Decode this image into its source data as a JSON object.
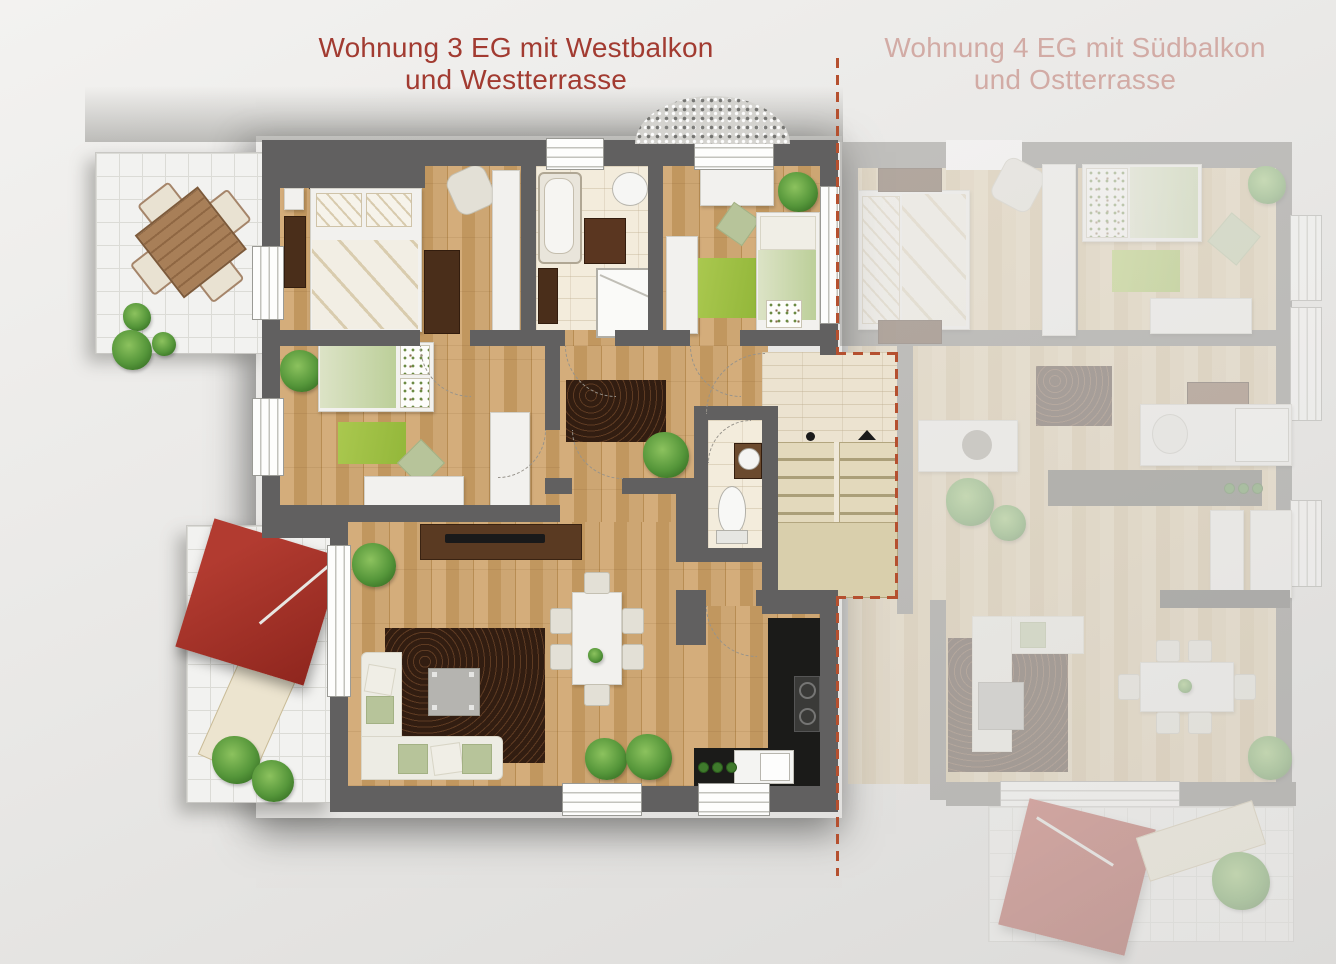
{
  "titles": {
    "apartment3": {
      "line1": "Wohnung 3 EG mit Westbalkon",
      "line2": "und Westterrasse"
    },
    "apartment4": {
      "line1": "Wohnung 4 EG mit Südbalkon",
      "line2": "und Ostterrasse"
    }
  },
  "colors": {
    "apartment3_title": "#a23b31",
    "apartment4_title": "#d2aba5",
    "boundary_dashed_line": "#b5502f",
    "active_wall": "#616060",
    "faded_wall": "#71706c",
    "wood_floor": "#c9a06b",
    "bath_tile": "#f3ecdc",
    "terrace_tile": "#f2f2f0",
    "stairs": "#e3d9bc",
    "kitchen_counter": "#1b1b19",
    "rug_brown": "#4c2d1a",
    "rug_green": "#9fbf3d",
    "parasol_red": "#a8322a",
    "background": "#e9e8e6"
  }
}
